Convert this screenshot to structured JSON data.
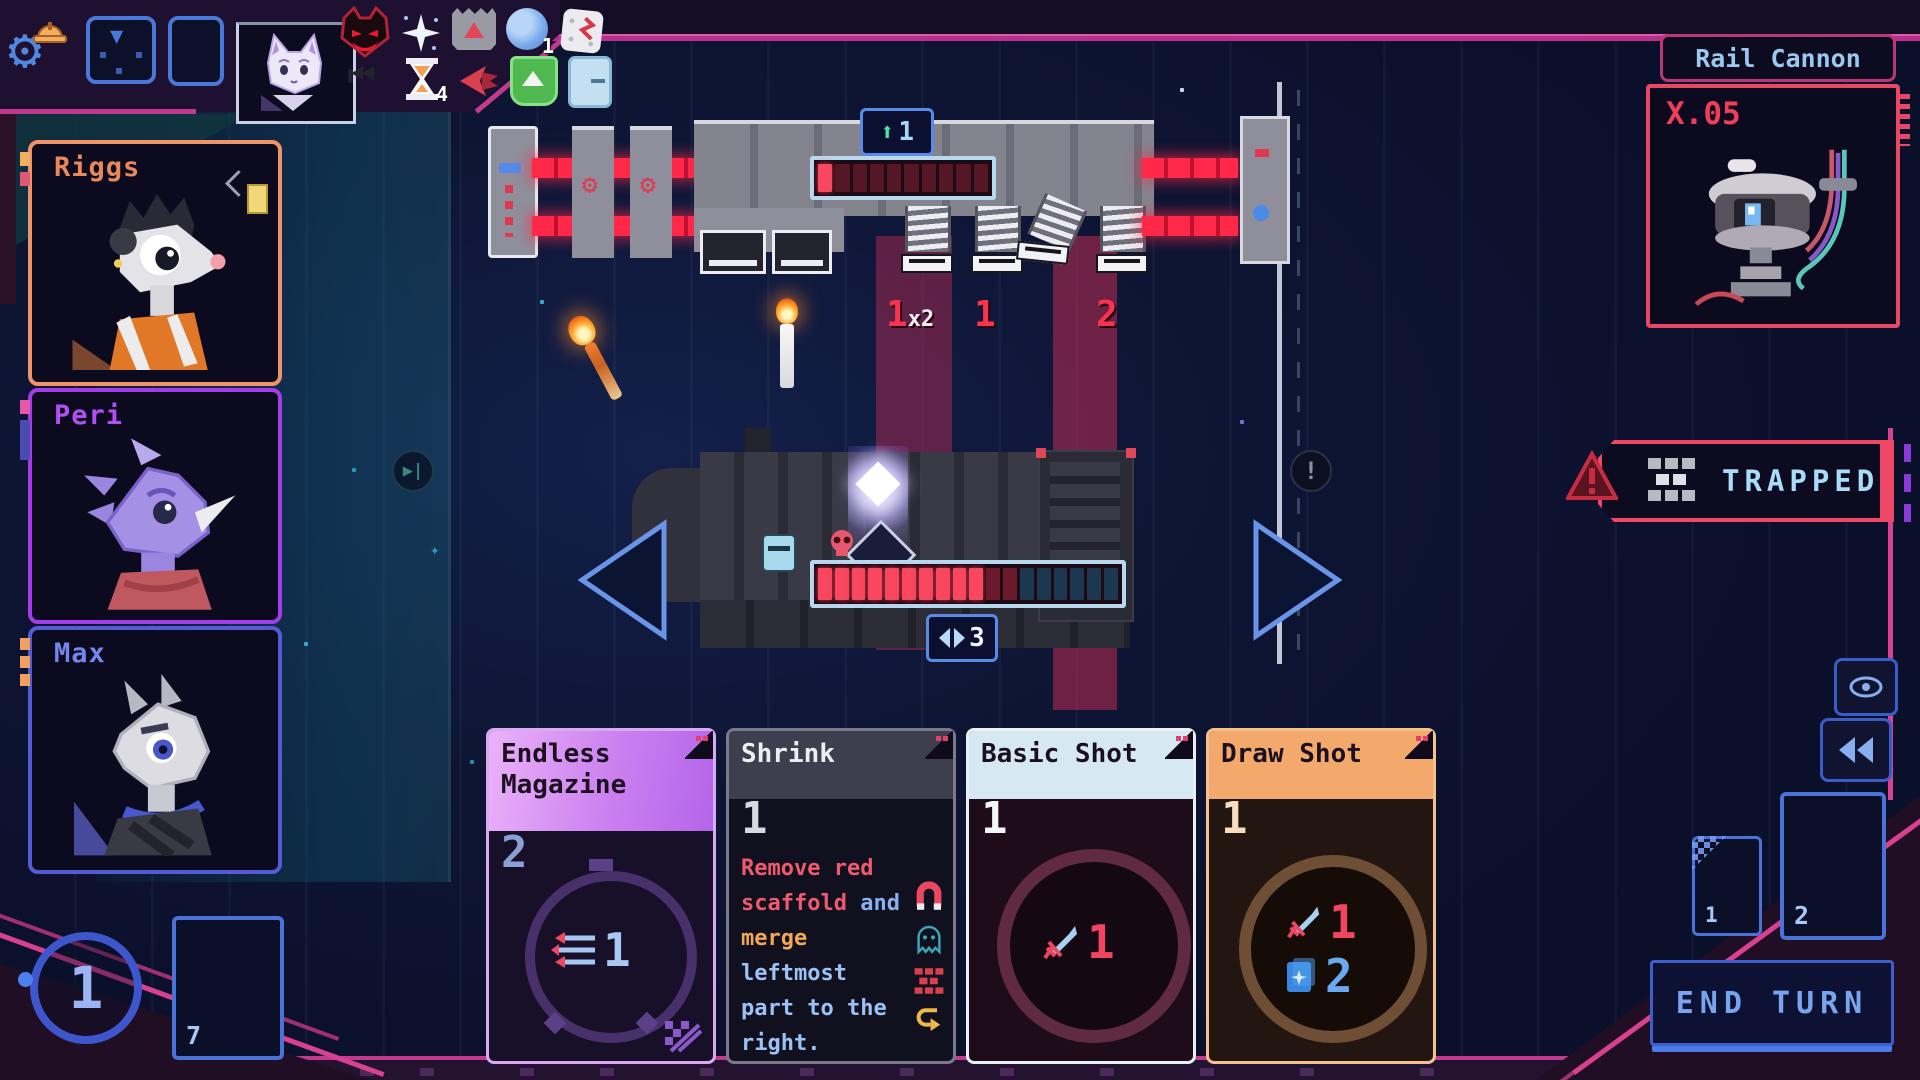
{
  "colors": {
    "accent_pink": "#c23a8c",
    "accent_blue": "#4a78d8",
    "hp_red": "#f8475f",
    "shield_teal": "#1c3850",
    "warning_red": "#ee4866",
    "energy_blue": "#9cb4f4"
  },
  "enemy_hud": {
    "moon_status_value": "1",
    "hourglass_status_value": "4"
  },
  "enemy_ship": {
    "boost_badge": "1",
    "hp_filled": 1,
    "hp_total": 10,
    "intents": [
      {
        "value": "1",
        "suffix": "x2"
      },
      {
        "value": "1",
        "suffix": ""
      },
      {
        "value": "2",
        "suffix": ""
      }
    ]
  },
  "player_ship": {
    "evade": "3",
    "hp_bright": 10,
    "hp_damaged": 2,
    "hp_shield": 6
  },
  "crew": [
    {
      "name": "Riggs"
    },
    {
      "name": "Peri"
    },
    {
      "name": "Max"
    }
  ],
  "inspect": {
    "title": "Rail Cannon",
    "stat": "X.05"
  },
  "alert": {
    "label": "TRAPPED"
  },
  "cards": [
    {
      "title": "Endless Magazine",
      "cost": "2",
      "value": "1"
    },
    {
      "title": "Shrink",
      "cost": "1",
      "desc": [
        {
          "text": "Remove red",
          "color": "red"
        },
        {
          "text": "scaffold",
          "color": "red"
        },
        {
          "text": " and",
          "color": "blue"
        },
        {
          "text": "merge",
          "color": "orange"
        },
        {
          "text": "leftmost",
          "color": "lightblue"
        },
        {
          "text": "part to the",
          "color": "lightblue"
        },
        {
          "text": "right.",
          "color": "lightblue"
        }
      ]
    },
    {
      "title": "Basic Shot",
      "cost": "1",
      "attack": "1"
    },
    {
      "title": "Draw Shot",
      "cost": "1",
      "attack": "1",
      "draw": "2"
    }
  ],
  "piles": {
    "draw": "7",
    "exhaust": "1",
    "discard": "2"
  },
  "energy": {
    "value": "1"
  },
  "end_turn": {
    "label": "END TURN"
  }
}
